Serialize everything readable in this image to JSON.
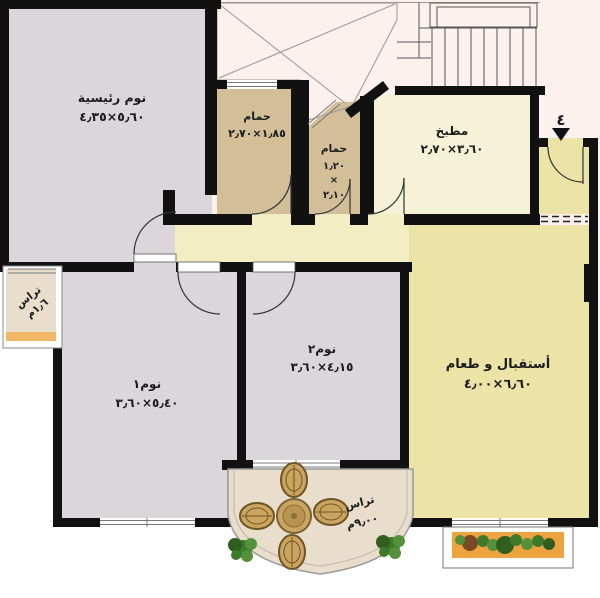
{
  "meta": {
    "type": "apartment-floor-plan",
    "language": "ar"
  },
  "rooms": {
    "master": {
      "name": "نوم رئيسية",
      "dims": "٥٫٦٠×٤٫٣٥"
    },
    "bath1": {
      "name": "حمام",
      "dims": "١٫٨٥×٢٫٧٠"
    },
    "bath2": {
      "name": "حمام",
      "dims_lines": [
        "١٫٢٠",
        "×",
        "٢٫١٠"
      ]
    },
    "kitchen": {
      "name": "مطبخ",
      "dims": "٣٫٦٠×٢٫٧٠"
    },
    "bedroom1": {
      "name": "نوم١",
      "dims": "٥٫٤٠×٣٫٦٠"
    },
    "bedroom2": {
      "name": "نوم٢",
      "dims": "٤٫١٥×٣٫٦٠"
    },
    "reception": {
      "name": "أستقبال و طعام",
      "dims": "٦٫٦٠×٤٫٠٠"
    },
    "terrace_left": {
      "name": "تراس",
      "dims": "١٫٦م"
    },
    "terrace_bottom": {
      "name": "تراس",
      "dims": "٩٫٠٠م"
    }
  },
  "entrance": {
    "unit_number": "٤"
  },
  "colors": {
    "exterior_pink": "#fdf1ee",
    "exterior_white": "#ffffff",
    "wall": "#111111",
    "bedroom_fill": "#dad6d9",
    "bath_fill": "#d2bf98",
    "kitchen_fill": "#f6f2d8",
    "hall_fill": "#f3edc3",
    "reception_fill": "#ece3a7",
    "terrace_fill": "#e9ddcc",
    "terrace_strip": "#f0b765",
    "planter_fill": "#eda440",
    "plant_green": "#3f7a2c",
    "wicker_tan": "#caa55f",
    "entrance_red": "#cf3a00"
  }
}
